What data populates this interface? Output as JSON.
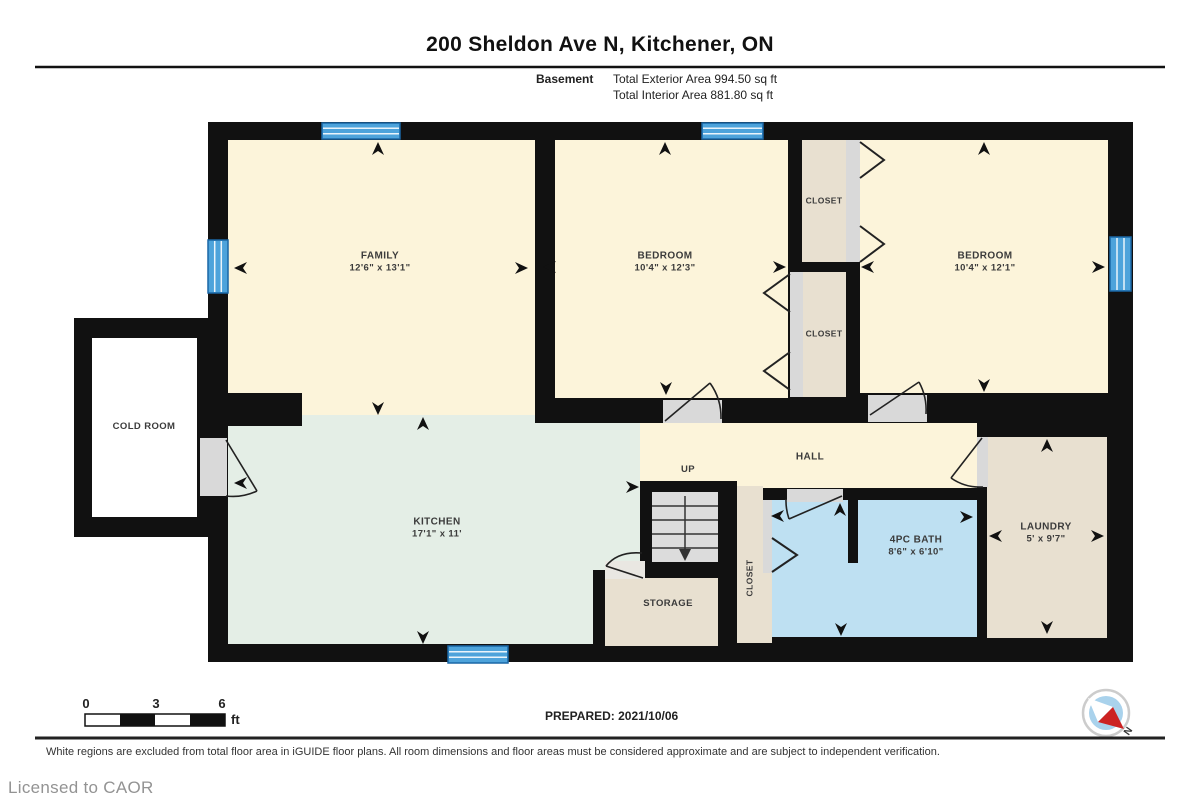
{
  "header": {
    "title": "200 Sheldon Ave N, Kitchener, ON",
    "floor_label": "Basement",
    "exterior_area": "Total Exterior Area 994.50 sq ft",
    "interior_area": "Total Interior Area 881.80 sq ft"
  },
  "plan": {
    "rooms": {
      "family": {
        "name": "FAMILY",
        "dims": "12'6\" x 13'1\""
      },
      "bedroom1": {
        "name": "BEDROOM",
        "dims": "10'4\" x 12'3\""
      },
      "bedroom2": {
        "name": "BEDROOM",
        "dims": "10'4\" x 12'1\""
      },
      "closet1": {
        "name": "CLOSET"
      },
      "closet2": {
        "name": "CLOSET"
      },
      "closet3": {
        "name": "CLOSET"
      },
      "cold_room": {
        "name": "COLD ROOM"
      },
      "kitchen": {
        "name": "KITCHEN",
        "dims": "17'1\" x 11'"
      },
      "hall": {
        "name": "HALL"
      },
      "stairs": {
        "label": "UP"
      },
      "storage": {
        "name": "STORAGE"
      },
      "bath": {
        "name": "4PC BATH",
        "dims": "8'6\" x 6'10\""
      },
      "laundry": {
        "name": "LAUNDRY",
        "dims": "5' x 9'7\""
      }
    },
    "compass": {
      "label": "N"
    }
  },
  "scale_bar": {
    "tick0": "0",
    "tick1": "3",
    "tick2": "6",
    "unit": "ft"
  },
  "footer": {
    "prepared": "PREPARED: 2021/10/06",
    "disclaimer": "White regions are excluded from total floor area in iGUIDE floor plans. All room dimensions and floor areas must be considered approximate and are subject to independent verification.",
    "license": "Licensed to CAOR"
  },
  "colors": {
    "wall": "#111111",
    "room_cream": "#fcf4da",
    "room_mint": "#e4eee6",
    "room_tan": "#e8e0d0",
    "room_bath_blue": "#bee0f2",
    "window_blue": "#4da3db",
    "window_border": "#1a67a6",
    "door_gap_gray": "#d9d9d9",
    "compass_red": "#cc2222",
    "compass_blue": "#a9d2ec"
  }
}
